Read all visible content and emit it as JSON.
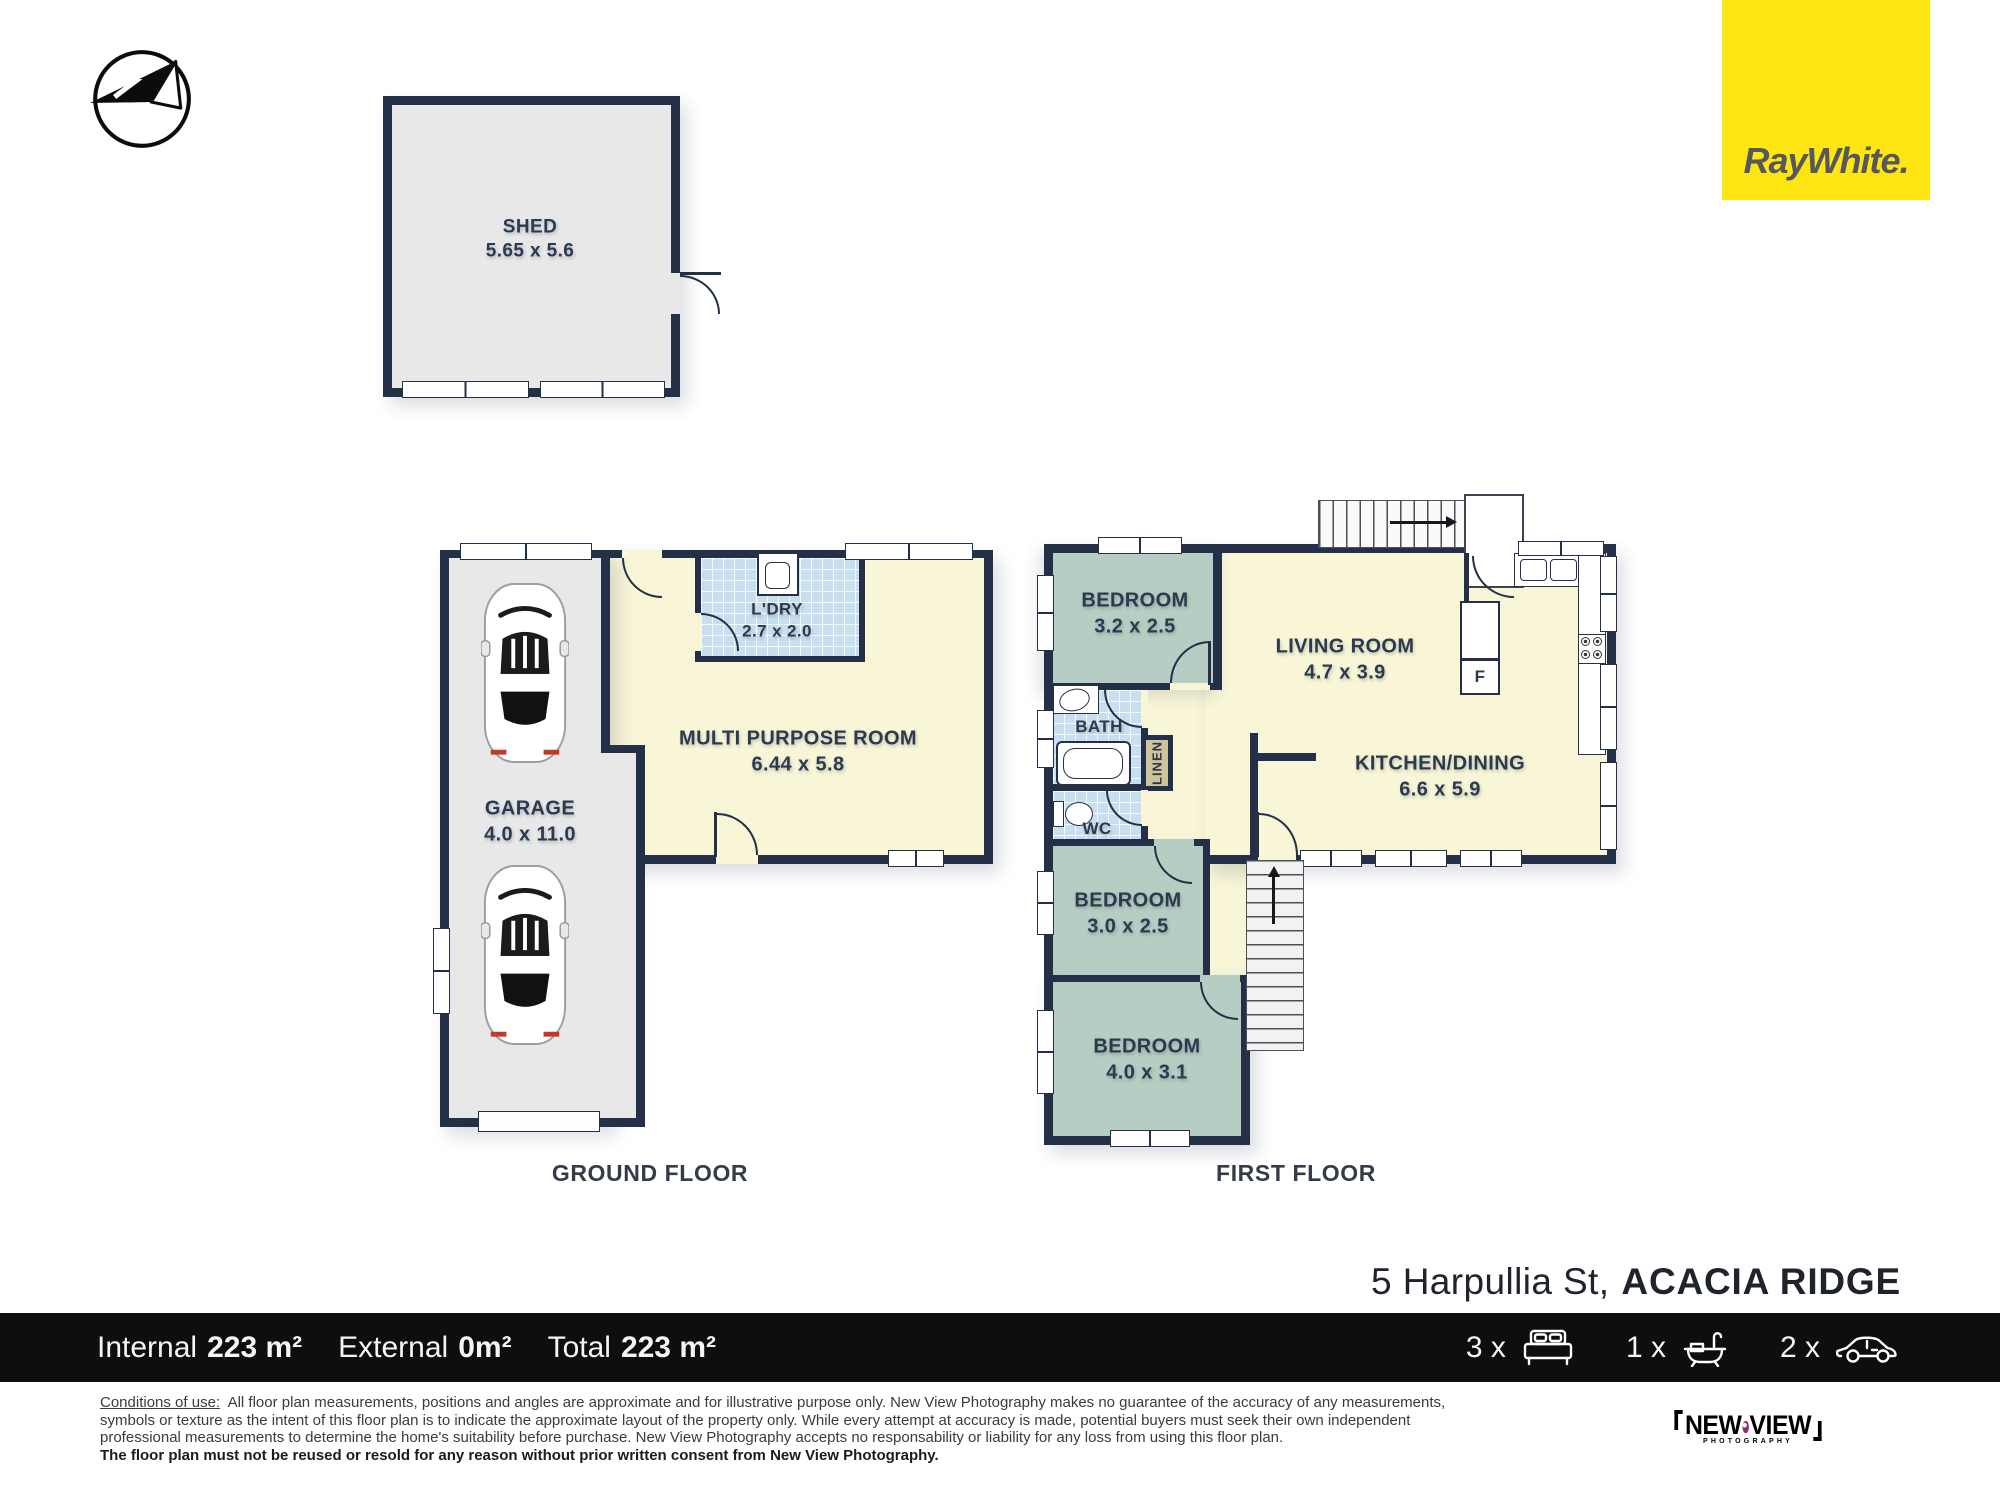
{
  "branding": {
    "agency_logo_text": "RayWhite.",
    "photographer_top": "NEW",
    "photographer_bottom": "VIEW",
    "photographer_sub": "PHOTOGRAPHY"
  },
  "address": {
    "street": "5 Harpullia St,",
    "suburb": "ACACIA RIDGE"
  },
  "floors": {
    "ground_caption": "GROUND FLOOR",
    "first_caption": "FIRST FLOOR"
  },
  "rooms": {
    "shed": {
      "name": "SHED",
      "dims": "5.65 x 5.6"
    },
    "garage": {
      "name": "GARAGE",
      "dims": "4.0 x 11.0"
    },
    "mpr": {
      "name": "MULTI PURPOSE ROOM",
      "dims": "6.44 x 5.8"
    },
    "ldry": {
      "name": "L'DRY",
      "dims": "2.7 x 2.0"
    },
    "bed1": {
      "name": "BEDROOM",
      "dims": "3.2 x 2.5"
    },
    "living": {
      "name": "LIVING ROOM",
      "dims": "4.7 x 3.9"
    },
    "bath": {
      "name": "BATH"
    },
    "linen": {
      "name": "LINEN"
    },
    "wc": {
      "name": "WC"
    },
    "kitchen": {
      "name": "KITCHEN/DINING",
      "dims": "6.6 x 5.9"
    },
    "bed2": {
      "name": "BEDROOM",
      "dims": "3.0 x 2.5"
    },
    "bed3": {
      "name": "BEDROOM",
      "dims": "4.0 x 3.1"
    },
    "fridge": {
      "name": "F"
    }
  },
  "summary": {
    "internal_label": "Internal",
    "internal_value": "223 m²",
    "external_label": "External",
    "external_value": "0m²",
    "total_label": "Total",
    "total_value": "223 m²",
    "beds": "3 x",
    "baths": "1 x",
    "cars": "2 x"
  },
  "legal": {
    "heading": "Conditions of use:",
    "line1": "All floor plan measurements, positions and angles are approximate and for illustrative purpose only. New View Photography makes no guarantee of the accuracy of any measurements,",
    "line2": "symbols or texture as the intent of this floor plan is to indicate the approximate layout of the property only. While every attempt at accuracy is made, potential buyers must seek their own independent",
    "line3": "professional measurements to determine the home's suitability before purchase. New View Photography accepts no responsability or liability for any loss from using this floor plan.",
    "line4": "The floor plan must not be reused or resold for any reason without prior written consent from New View Photography."
  },
  "colors": {
    "agency_yellow": "#FFE512",
    "wall_navy": "#233048",
    "photographer_purple": "#8D2E6F"
  }
}
